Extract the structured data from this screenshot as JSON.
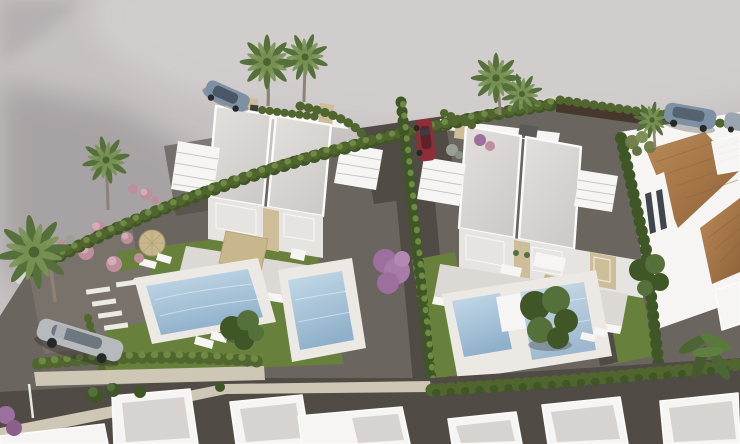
{
  "scene": {
    "type": "aerial-architectural-render",
    "description": "Aerial 3D render of a new-build residential development: two white flat-roof duplex villas with private pools, lawns and gravel gardens beside a curved empty road; parked cars, hedge boundaries, palm trees, a terracotta-roofed neighbouring house on the right and a row of white roofs along the bottom.",
    "villa_blocks": 2,
    "pools": 4,
    "cars": 5,
    "palm_trees": 7
  },
  "colors": {
    "road": "#c6c1c1",
    "road_light": "#d2cecd",
    "road_shadow": "#a09b9d",
    "sidewalk": "#d8d4d2",
    "gravel": "#6b655f",
    "gravel_dark": "#504b45",
    "garden_gravel": "#79726b",
    "lawn": "#67803c",
    "hedge": "#51662f",
    "hedge_light": "#6f8a43",
    "tree_dark": "#3f5626",
    "palm_green": "#55703a",
    "trunk": "#8d8275",
    "roof": "#d8d5d2",
    "white_roof_top": "#d6d3d0",
    "wall_white": "#f6f5f3",
    "wall_shade": "#e6e4e1",
    "parapet": "#fbfbfa",
    "stone": "#cdbd98",
    "window": "#3f464d",
    "deck": "#ece9e4",
    "terrace": "#dcd8d4",
    "pergola": "#c8b68d",
    "pool_light": "#c6dbe9",
    "pool_dark": "#8fb0ca",
    "terracotta": "#a97c52",
    "wall_brown": "#46382c",
    "stone_wall": "#cfc7b6",
    "car_red": "#8f2e38",
    "car_silver": "#b7babd",
    "car_blue": "#7e91a4",
    "pink": "#bd8f9d",
    "purple": "#9c6f9f"
  }
}
